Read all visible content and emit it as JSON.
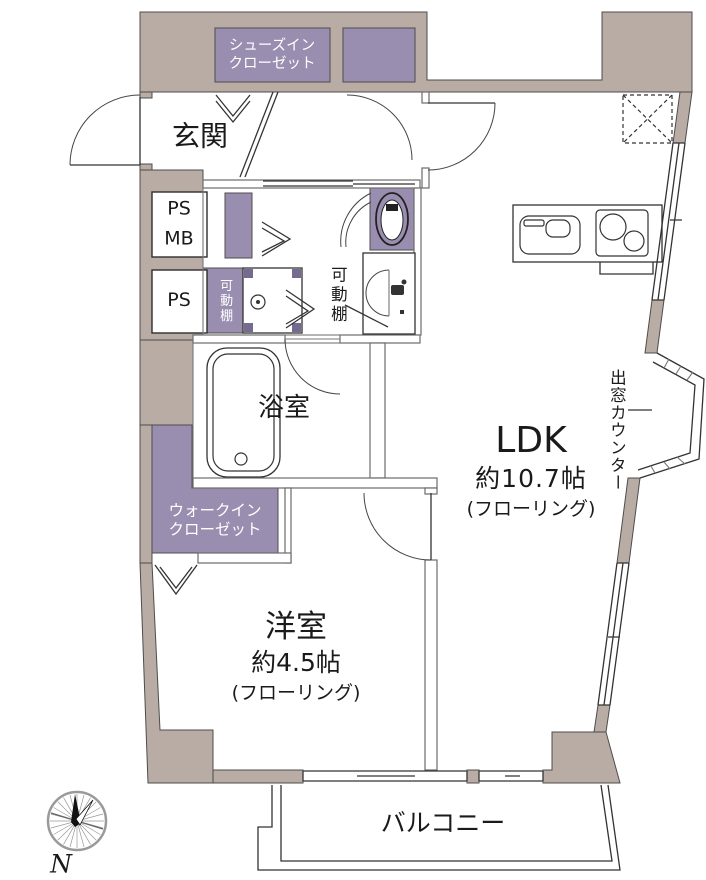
{
  "colors": {
    "wall": "#b8aca5",
    "closet": "#9a8eb0",
    "outline": "#4d4d4d",
    "text": "#1a1a1a",
    "white_text": "#ffffff"
  },
  "rooms": {
    "genkan": {
      "label": "玄関"
    },
    "shoes_closet": {
      "line1": "シューズイン",
      "line2": "クローゼット"
    },
    "ps_mb": {
      "line1": "PS",
      "line2": "MB"
    },
    "ps": {
      "label": "PS"
    },
    "washroom_shelf": {
      "label": "可動棚"
    },
    "toilet_shelf": {
      "label": "可動棚"
    },
    "bathroom": {
      "label": "浴室"
    },
    "ldk": {
      "name": "LDK",
      "size": "約10.7帖",
      "flooring": "(フローリング)"
    },
    "walk_in_closet": {
      "line1": "ウォークイン",
      "line2": "クローゼット"
    },
    "western_room": {
      "name": "洋室",
      "size": "約4.5帖",
      "flooring": "(フローリング)"
    },
    "balcony": {
      "label": "バルコニー"
    },
    "bay_window_counter": {
      "label": "出窓カウンター"
    }
  },
  "compass": {
    "label": "N"
  },
  "icons": [
    "compass-icon",
    "bathtub-icon",
    "kitchen-sink-icon",
    "stove-icon",
    "toilet-icon",
    "washer-pan-icon",
    "vanity-sink-icon",
    "refrigerator-dashed-box",
    "door-arc",
    "folding-door-icon",
    "sliding-window",
    "bay-window"
  ]
}
